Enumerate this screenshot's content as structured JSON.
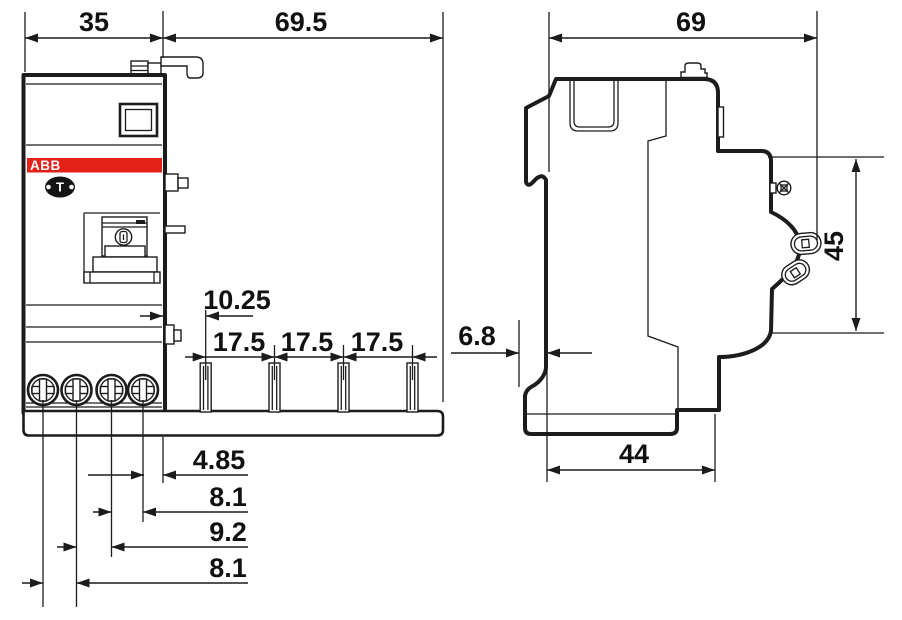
{
  "brand": {
    "logo": "ABB",
    "red": "#e32119"
  },
  "front_view": {
    "dim_module_width": "35",
    "dim_pin_span": "69.5",
    "dim_pin_offset": "10.25",
    "dim_pin_pitch_1": "17.5",
    "dim_pin_pitch_2": "17.5",
    "dim_pin_pitch_3": "17.5",
    "dim_terminal_1": "4.85",
    "dim_terminal_2": "8.1",
    "dim_terminal_3": "9.2",
    "dim_terminal_4": "8.1",
    "test_button_label": "T"
  },
  "side_view": {
    "dim_depth": "69",
    "dim_din_offset": "6.8",
    "dim_base_depth": "44",
    "dim_height": "45"
  }
}
